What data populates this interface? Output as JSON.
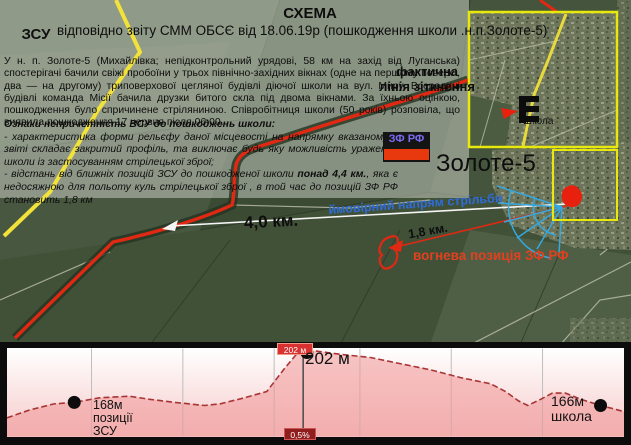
{
  "header": {
    "title": "СХЕМА",
    "subtitle": "відповідно звіту СММ ОБСЄ від 18.06.19р (пошкодження школи .н.п.Золоте-5)"
  },
  "badges": {
    "zsu": "ЗСУ",
    "zf_rf": "ЗФ РФ"
  },
  "report": {
    "text": "У н. п. Золоте-5 (Михайлівка; непідконтрольний урядові, 58 км на захід від Луганська) спостерігачі бачили свіжі пробоїни у трьох північно-західних вікнах (одне на першому поверсі, два — на другому) триповерхової цегляної будівлі діючої школи на вул. Миру. Всередині будівлі команда Місії бачила друзки битого скла під двома вікнами. За їхньою оцінкою, пошкодження було спричинене стріляниною. Співробітниця школи (50 років) розповіла, що виявила пошкодження 17 червня після 06:00."
  },
  "conclusions": {
    "heading": "Ознаки непричетність ВСУ до пошкоджень школи:",
    "point1": "- характеристика форми рельєфу даної місцевості  на напрямку вказаному у звіті складає закритий профіль, та виключає будь яку можливість ураження школи із застосуванням стрілецької зброї;",
    "point2_pre": "- відстань від ближніх позицій ЗСУ до пошкодженої школи ",
    "point2_bold": "понад 4,4 км.",
    "point2_post": ", яка є недосяжною для польоту куль стрілецької зброї , в той час  до позицій ЗФ РФ становить 1,8 км"
  },
  "map": {
    "contact_line_label": "фактична лінія зіткнення",
    "town_label": "Золоте-5",
    "direction_label": "ймовірний напрям стрільби",
    "distance_total": "4,0 км.",
    "distance_enemy": "1,8 км.",
    "fire_position_label": "вогнева позиція ЗФ РФ"
  },
  "inset": {
    "school_label": "Школа"
  },
  "profile_labels": {
    "peak_badge": "202 м",
    "peak_label": "202 м",
    "slope_badge": "0,5%",
    "start_elevation": "168м",
    "start_line2": "позиції",
    "start_line3": "ЗСУ",
    "end_elevation": "166м",
    "end_line2": "школа"
  },
  "colors": {
    "accent_red": "#e02812",
    "accent_yellow": "#f2e23a",
    "accent_blue": "#35a8e0",
    "flag_blue": "#3c6fd1",
    "flag_yellow": "#f8d407",
    "zf_stripe": "#e8390e",
    "profile_fill": "#f2a8a8",
    "badge_red": "#d93030",
    "badge_dark_red": "#8f1d1d"
  },
  "chart_data": {
    "type": "area",
    "title": "",
    "elevations_m": {
      "start": 168,
      "peak": 202,
      "end": 166
    },
    "slope_label": "0,5%",
    "points": [
      [
        0.0,
        158
      ],
      [
        0.036,
        163
      ],
      [
        0.076,
        167
      ],
      [
        0.109,
        168
      ],
      [
        0.15,
        171
      ],
      [
        0.198,
        172
      ],
      [
        0.231,
        170
      ],
      [
        0.272,
        168
      ],
      [
        0.32,
        166
      ],
      [
        0.345,
        167
      ],
      [
        0.385,
        171
      ],
      [
        0.421,
        175
      ],
      [
        0.45,
        190
      ],
      [
        0.471,
        200
      ],
      [
        0.486,
        202
      ],
      [
        0.504,
        201
      ],
      [
        0.54,
        199
      ],
      [
        0.589,
        197
      ],
      [
        0.637,
        193
      ],
      [
        0.686,
        189
      ],
      [
        0.735,
        184
      ],
      [
        0.784,
        180
      ],
      [
        0.808,
        175
      ],
      [
        0.829,
        169
      ],
      [
        0.844,
        166
      ],
      [
        0.865,
        170
      ],
      [
        0.884,
        174
      ],
      [
        0.905,
        174
      ],
      [
        0.93,
        170
      ],
      [
        0.962,
        166
      ],
      [
        0.982,
        164
      ],
      [
        1.0,
        162
      ]
    ],
    "dots": [
      [
        0.109,
        168
      ],
      [
        0.486,
        202
      ],
      [
        0.962,
        166
      ]
    ],
    "gridlines": [
      0.137,
      0.285,
      0.433,
      0.572,
      0.72,
      0.868
    ],
    "peak_line_f": 0.48
  }
}
